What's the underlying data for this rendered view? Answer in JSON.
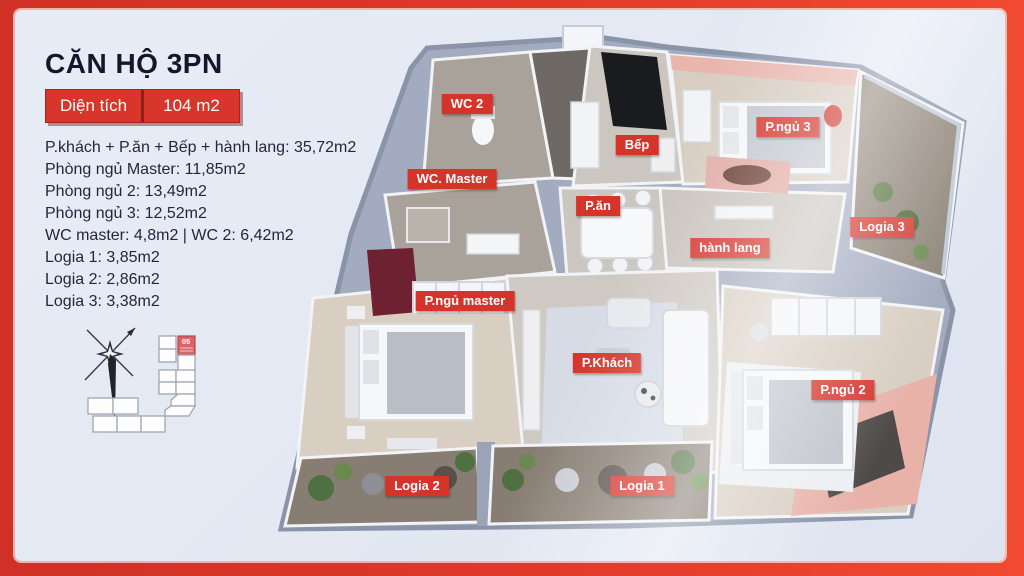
{
  "header": {
    "title": "CĂN HỘ 3PN",
    "area_label": "Diện tích",
    "area_value": "104 m2"
  },
  "area_list": [
    "P.khách + P.ăn + Bếp + hành lang: 35,72m2",
    "Phòng ngủ Master: 11,85m2",
    "Phòng ngủ 2: 13,49m2",
    "Phòng ngủ 3: 12,52m2",
    "WC master: 4,8m2 | WC 2: 6,42m2",
    "Logia 1: 3,85m2",
    "Logia 2: 2,86m2",
    "Logia 3: 3,38m2"
  ],
  "site_plan": {
    "unit_number": "05"
  },
  "floor_plan": {
    "labels": [
      {
        "text": "WC 2",
        "x": 452,
        "y": 94
      },
      {
        "text": "WC. Master",
        "x": 437,
        "y": 169
      },
      {
        "text": "Bếp",
        "x": 622,
        "y": 135
      },
      {
        "text": "P.ăn",
        "x": 583,
        "y": 196
      },
      {
        "text": "P.ngủ 3",
        "x": 773,
        "y": 117
      },
      {
        "text": "Logia 3",
        "x": 867,
        "y": 217
      },
      {
        "text": "hành lang",
        "x": 715,
        "y": 238
      },
      {
        "text": "P.ngủ master",
        "x": 450,
        "y": 291
      },
      {
        "text": "P.Khách",
        "x": 592,
        "y": 353
      },
      {
        "text": "P.ngủ 2",
        "x": 828,
        "y": 380
      },
      {
        "text": "Logia 2",
        "x": 402,
        "y": 476
      },
      {
        "text": "Logia 1",
        "x": 627,
        "y": 476
      }
    ]
  },
  "colors": {
    "frame_red": "#dd3829",
    "badge_red": "#d8352b",
    "label_red": "#d5342b",
    "panel_blue": "#e3e8f3",
    "title_navy": "#15152b"
  }
}
